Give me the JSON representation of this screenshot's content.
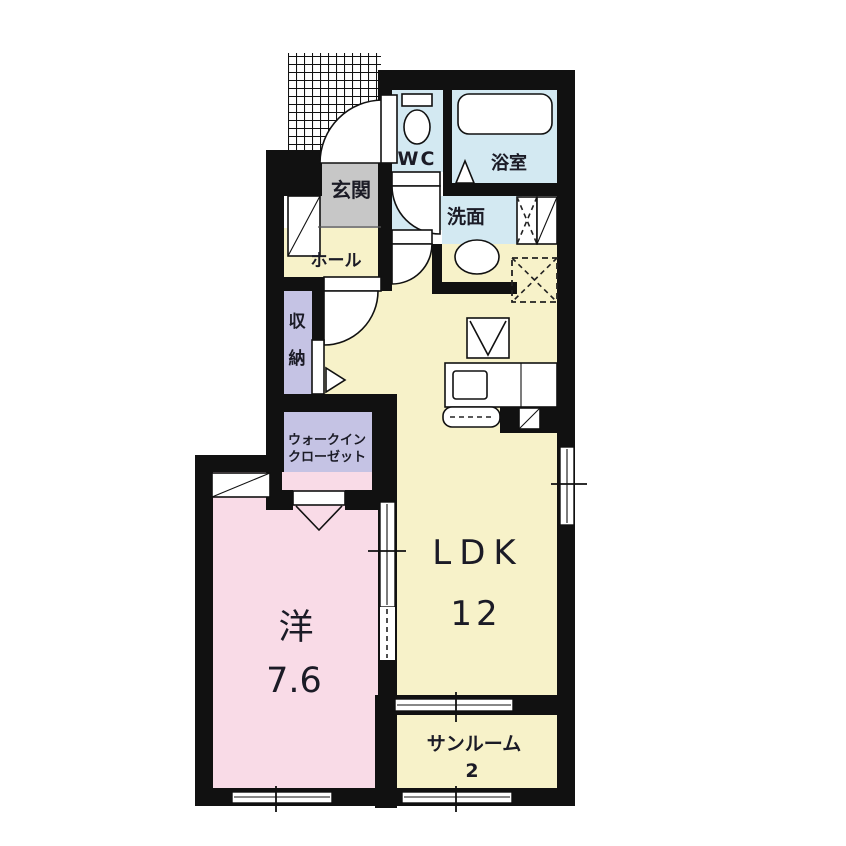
{
  "plan": {
    "type": "japanese-apartment-floor-plan",
    "colors": {
      "wall": "#111111",
      "floor_yellow": "#f7f2c9",
      "floor_pink": "#f9dbe7",
      "floor_blue": "#d3e9f2",
      "floor_lavender": "#c5c3e4",
      "floor_gray": "#c7c7c7",
      "fixture_white": "#ffffff",
      "background": "#ffffff"
    },
    "rooms": {
      "genkan": {
        "label": "玄関"
      },
      "hall": {
        "label": "ホール"
      },
      "wc": {
        "label": "WC"
      },
      "bath": {
        "label": "浴室"
      },
      "washroom": {
        "label": "洗面"
      },
      "storage": {
        "label": "収納",
        "chars": [
          "収",
          "納"
        ]
      },
      "wic": {
        "label_line1": "ウォークイン",
        "label_line2": "クローゼット"
      },
      "ldk": {
        "label": "LDK",
        "size": "12"
      },
      "western": {
        "label": "洋",
        "size": "7.6"
      },
      "sunroom": {
        "label": "サンルーム",
        "size": "2"
      }
    },
    "icons": {
      "bathtub": "bathtub-icon",
      "toilet": "toilet-icon",
      "washbasin": "washbasin-oval-icon",
      "stove": "stove-triangle-icon",
      "kitchen_counter": "kitchen-counter-icon",
      "kitchen_sink": "kitchen-sink-icon",
      "refrigerator_space": "refrigerator-dashed-square-icon",
      "pipe_space": "pipe-space-icon",
      "shoe_cabinet": "shoe-cabinet-icon",
      "cabinet": "cabinet-diagonal-icon",
      "laundry_space": "laundry-dashed-icon",
      "porch_tiles": "entrance-porch-hatch",
      "door_swing": "door-swing-arc-icon",
      "folding_door": "folding-door-v-icon",
      "sliding_door": "sliding-door-icon",
      "window": "sliding-window-icon"
    }
  }
}
